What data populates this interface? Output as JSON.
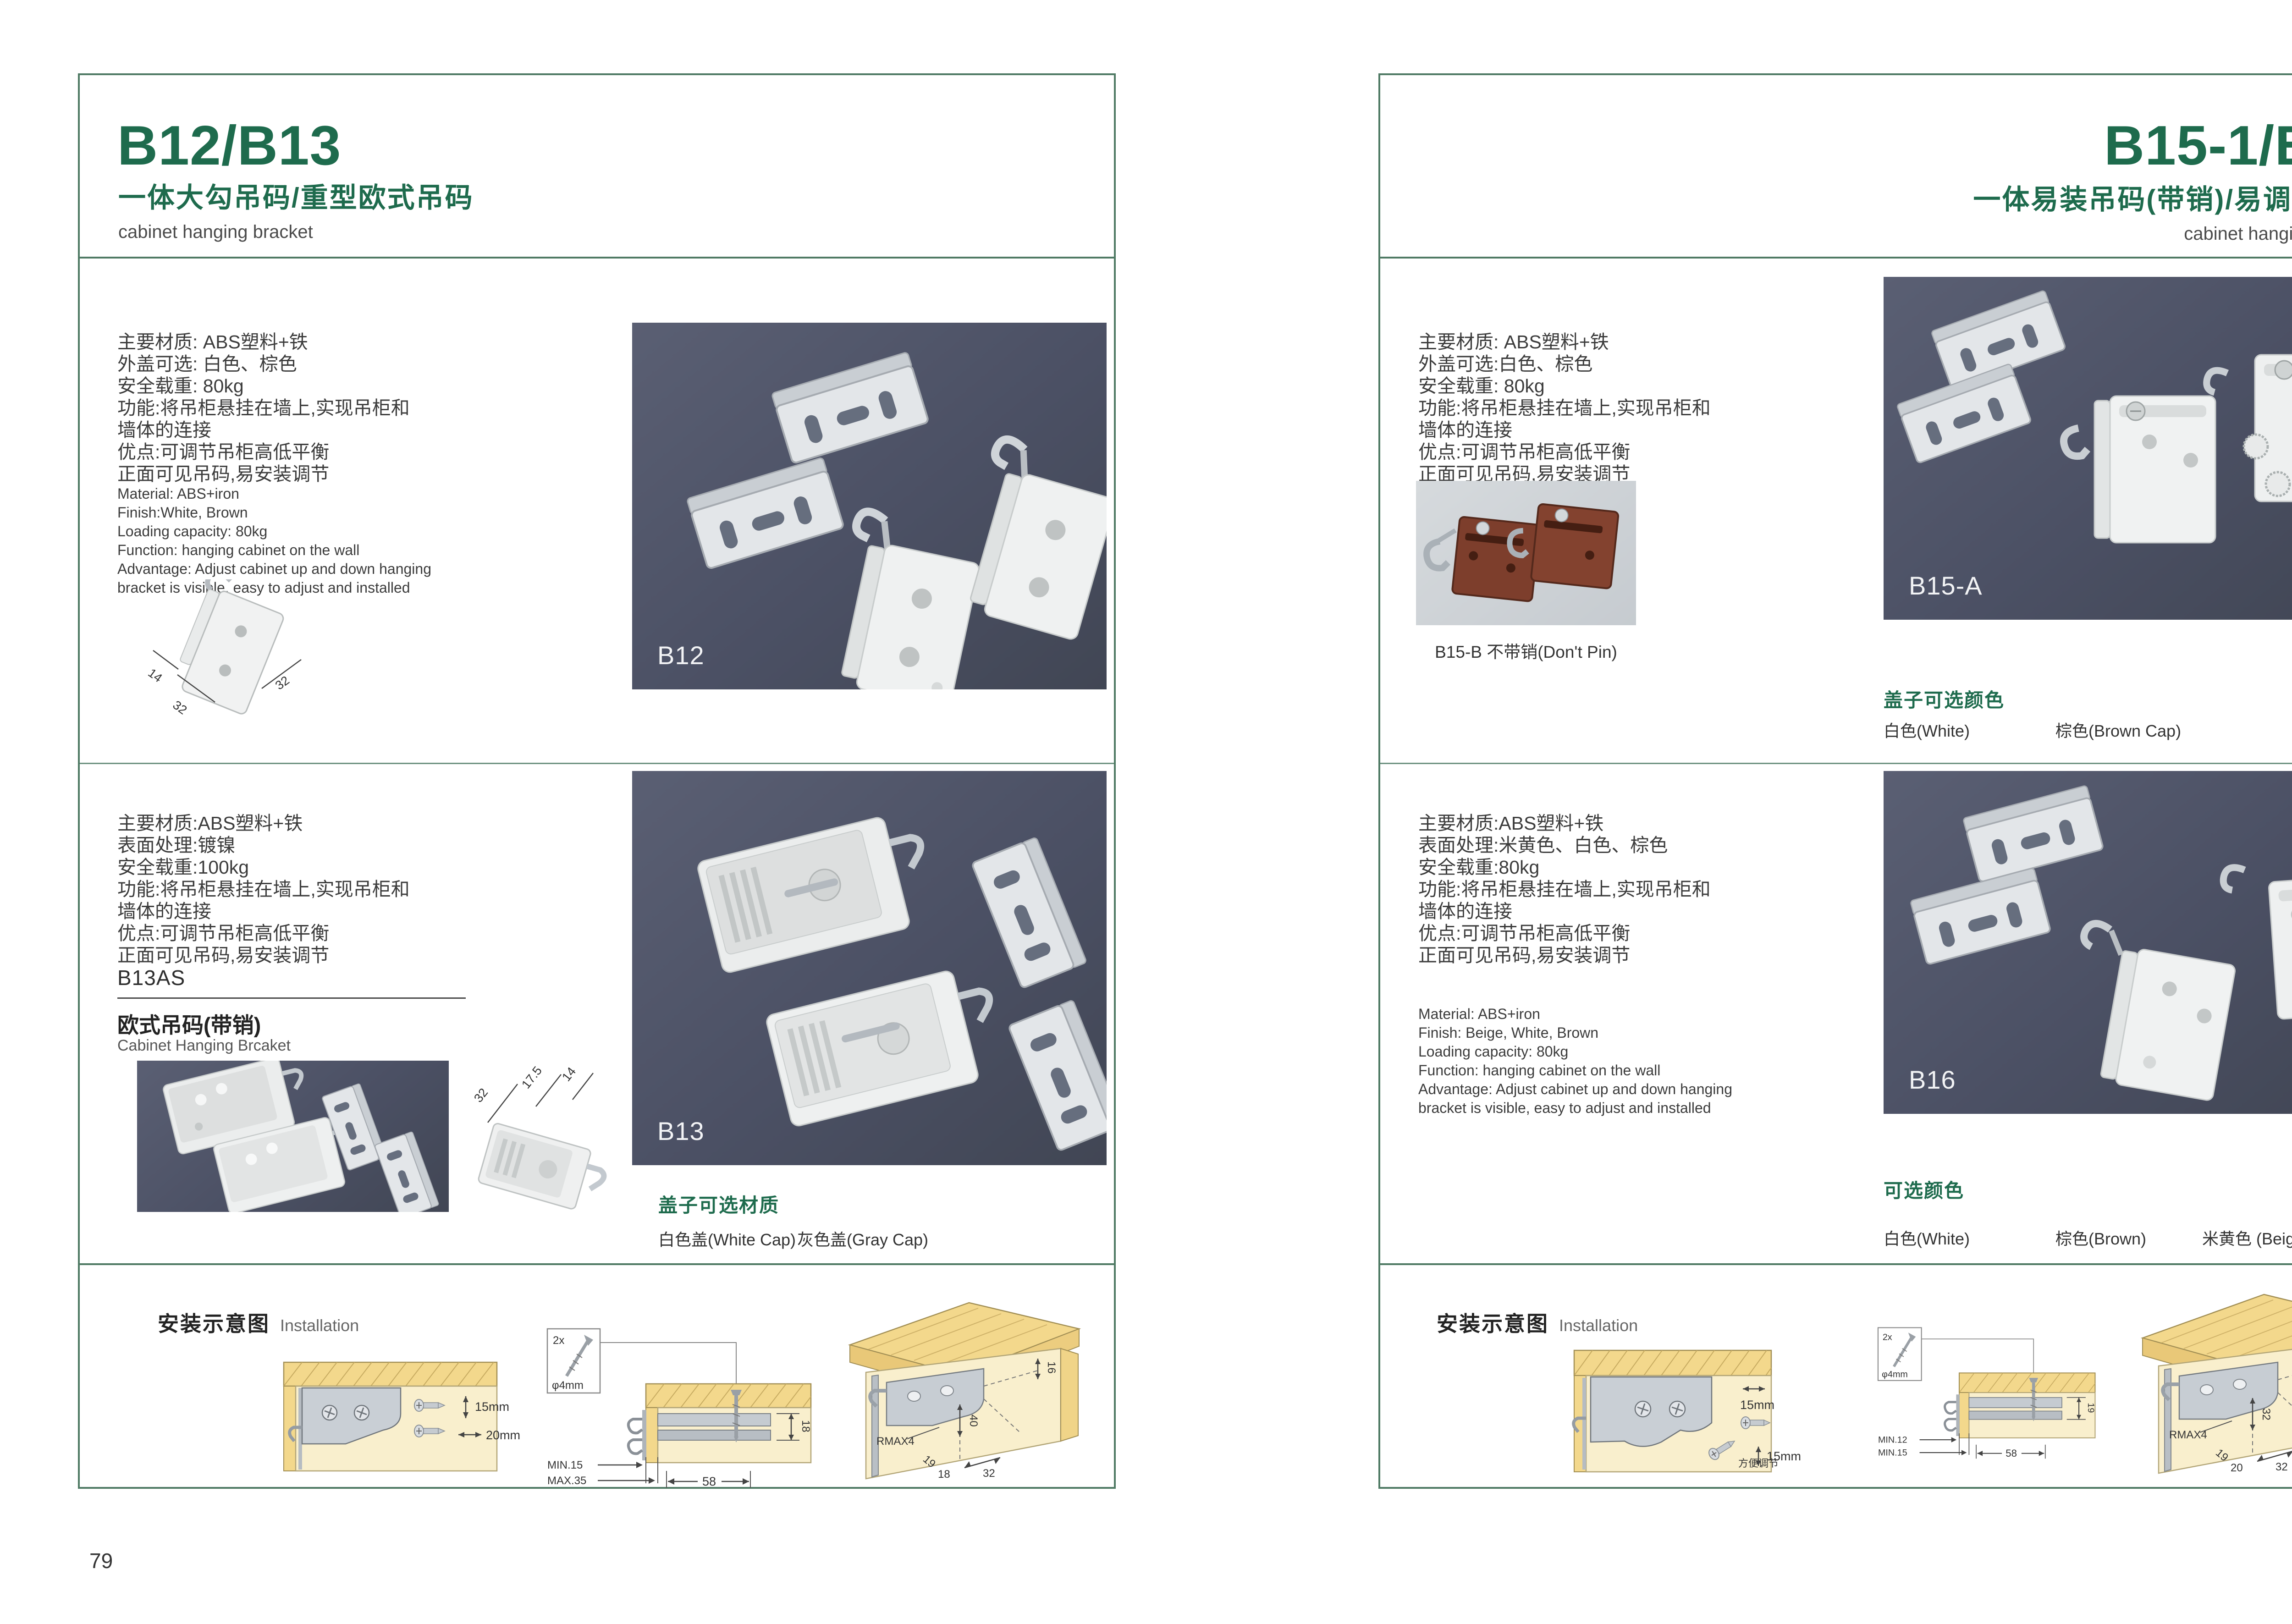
{
  "colors": {
    "accent_green": "#1e6b4d",
    "border_green": "#4f7a64",
    "photo_bg_dark": "#4b5064",
    "photo_bg_light": "#c9ced3",
    "wood_tan": "#f3d88c",
    "panel_beige": "#f9efcd",
    "bracket_brown": "#7d3e2c"
  },
  "left_page": {
    "page_number": "79",
    "header": {
      "title": "B12/B13",
      "subtitle_cn": "一体大勾吊码/重型欧式吊码",
      "subtitle_en": "cabinet hanging bracket"
    },
    "product1": {
      "specs_cn": "主要材质: ABS塑料+铁\n外盖可选: 白色、棕色\n安全载重: 80kg\n功能:将吊柜悬挂在墙上,实现吊柜和\n墙体的连接\n优点:可调节吊柜高低平衡\n正面可见吊码,易安装调节",
      "specs_en": "Material: ABS+iron\nFinish:White, Brown\nLoading capacity: 80kg\nFunction: hanging cabinet on the wall\nAdvantage: Adjust cabinet up and down hanging\nbracket is visible, easy to adjust and installed",
      "dims": {
        "a": "14",
        "b": "32",
        "c": "32"
      },
      "photo_label": "B12"
    },
    "product2": {
      "specs_cn": "主要材质:ABS塑料+铁\n表面处理:镀镍\n安全载重:100kg\n功能:将吊柜悬挂在墙上,实现吊柜和\n墙体的连接\n优点:可调节吊柜高低平衡\n正面可见吊码,易安装调节",
      "model_code": "B13AS",
      "model_name_cn": "欧式吊码(带销)",
      "model_name_en": "Cabinet Hanging Brcaket",
      "dims": {
        "a": "32",
        "b": "17.5",
        "c": "14"
      },
      "photo_label": "B13",
      "options_title": "盖子可选材质",
      "options": [
        "白色盖(White Cap)",
        "灰色盖(Gray Cap)"
      ]
    },
    "installation": {
      "title_cn": "安装示意图",
      "title_en": "Installation",
      "d1": {
        "dim1": "15mm",
        "dim2": "20mm"
      },
      "d2": {
        "screw_count": "2x",
        "screw_dia": "φ4mm",
        "side": "18",
        "min": "MIN.15",
        "max": "MAX.35",
        "width": "58"
      },
      "d3": {
        "edge": "16",
        "depth": "40",
        "radius": "RMAX4",
        "a": "19",
        "b": "18",
        "c": "32"
      }
    }
  },
  "right_page": {
    "page_number": "80",
    "header": {
      "title": "B15-1/B16",
      "subtitle_cn": "一体易装吊码(带销)/易调节吊码",
      "subtitle_en": "cabinet hanging bracket"
    },
    "product1": {
      "specs_cn": "主要材质: ABS塑料+铁\n外盖可选:白色、棕色\n安全载重: 80kg\n功能:将吊柜悬挂在墙上,实现吊柜和\n墙体的连接\n优点:可调节吊柜高低平衡\n正面可见吊码,易安装调节",
      "sub_photo_caption": "B15-B 不带销(Don't Pin)",
      "photo_label": "B15-A",
      "options_title": "盖子可选颜色",
      "options": [
        "白色(White)",
        "棕色(Brown Cap)"
      ]
    },
    "product2": {
      "specs_cn": "主要材质:ABS塑料+铁\n表面处理:米黄色、白色、棕色\n安全载重:80kg\n功能:将吊柜悬挂在墙上,实现吊柜和\n墙体的连接\n优点:可调节吊柜高低平衡\n正面可见吊码,易安装调节",
      "specs_en": "Material: ABS+iron\nFinish: Beige, White, Brown\nLoading capacity: 80kg\nFunction: hanging cabinet on the wall\nAdvantage: Adjust cabinet up and down hanging\nbracket is visible, easy to adjust and installed",
      "photo_label": "B16",
      "options_title": "可选颜色",
      "options": [
        "白色(White)",
        "棕色(Brown)",
        "米黄色 (Beige)"
      ]
    },
    "installation": {
      "title_cn": "安装示意图",
      "title_en": "Installation",
      "d1": {
        "dim1": "15mm",
        "dim2": "15mm",
        "note": "方便调节"
      },
      "d2": {
        "screw_count": "2x",
        "screw_dia": "φ4mm",
        "side": "19",
        "min": "MIN.12",
        "max": "MIN.15",
        "width": "58"
      },
      "d3": {
        "edge": "30",
        "depth": "32",
        "radius": "RMAX4",
        "a": "19",
        "b": "20",
        "c": "32"
      }
    }
  }
}
